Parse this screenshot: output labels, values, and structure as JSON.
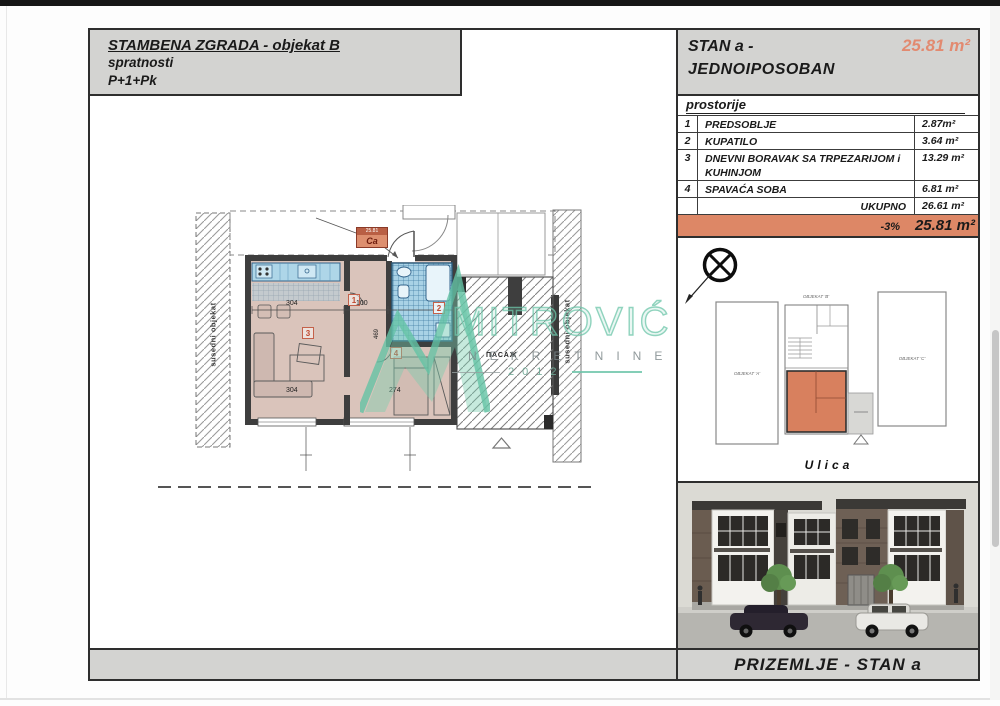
{
  "header_left": {
    "title": "STAMBENA ZGRADA - objekat B",
    "sub1": "spratnosti",
    "sub2": "P+1+Pk"
  },
  "header_right": {
    "line1": "STAN a -",
    "line2": "JEDNOIPOSOBAN",
    "area": "25.81 m²"
  },
  "table": {
    "title": "prostorije",
    "rows": [
      {
        "num": "1",
        "name": "PREDSOBLJE",
        "area": "2.87m²"
      },
      {
        "num": "2",
        "name": "KUPATILO",
        "area": "3.64 m²"
      },
      {
        "num": "3",
        "name": "DNEVNI BORAVAK SA TRPEZARIJOM i KUHINJOM",
        "area": "13.29 m²"
      },
      {
        "num": "4",
        "name": "SPAVAĆA SOBA",
        "area": "6.81 m²"
      }
    ],
    "total_label": "UKUPNO",
    "total_area": "26.61 m²",
    "discount": "-3%",
    "discounted_area": "25.81 m²"
  },
  "plan": {
    "adjacent_left": "susedni objekat",
    "adjacent_right": "susedni objekat",
    "tag_area": "25.81",
    "tag_code": "Ca",
    "passage": "ПАСАЖ",
    "marker1": "1",
    "marker2": "2",
    "marker3": "3",
    "marker4": "4",
    "dim_304a": "304",
    "dim_100": "100",
    "dim_469": "469",
    "dim_304b": "304",
    "dim_274": "274"
  },
  "watermark": {
    "brand": "MITROVIĆ",
    "line2": "NEKRETNINE",
    "year": "2012"
  },
  "siteplan": {
    "objekat_a": "OBJEKAT 'A'",
    "objekat_b": "OBJEKAT 'B'",
    "objekat_c": "OBJEKAT 'C'",
    "street": "Ulica"
  },
  "footer": {
    "label": "PRIZEMLJE - STAN a"
  },
  "colors": {
    "accent_fill": "#dd8766",
    "accent_text": "#e28a70",
    "gray_panel": "#d3d3d1",
    "watermark_teal": "#7fd0b6",
    "floor_fill": "#dac4bb",
    "wall_fill": "#3e3e3e"
  }
}
